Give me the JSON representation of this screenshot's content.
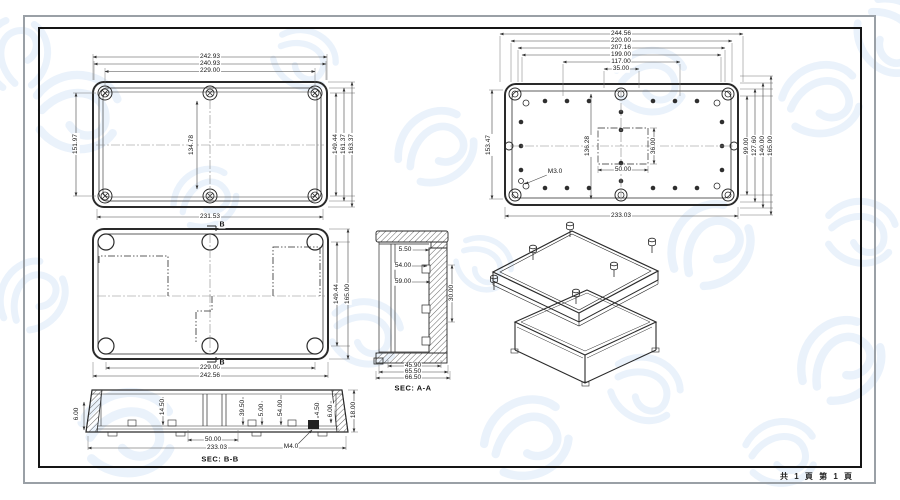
{
  "page": {
    "footer_pages": "共 1 頁  第 1 頁"
  },
  "views": {
    "lid_top_view": {
      "dims": {
        "width_outer": "242.93",
        "width_mid": "240.93",
        "width_screws": "229.00",
        "width_bottom": "231.53",
        "height_left": "151.97",
        "height_center": "134.78",
        "height_screws": "149.44",
        "height_mid": "161.37",
        "height_outer": "163.37"
      }
    },
    "base_top_view": {
      "dims": {
        "w1": "244.56",
        "w2": "220.00",
        "w3": "207.16",
        "w4": "199.00",
        "w5": "117.00",
        "w6": "35.00",
        "height_left": "153.47",
        "height_center": "136.28",
        "pocket_width": "50.00",
        "pocket_height": "36.00",
        "r1": "99.00",
        "r2": "127.60",
        "r3": "140.00",
        "r4": "165.00",
        "width_bottom": "233.03",
        "thread_note": "M3.0"
      }
    },
    "box_top_view": {
      "section_marker": "B",
      "dims": {
        "height_screws": "149.44",
        "height_outer": "165.00",
        "width_screws": "229.00",
        "width_outer": "242.56"
      }
    },
    "section_aa": {
      "title": "SEC: A-A",
      "dims": {
        "lip": "5.50",
        "inner_depth": "54.00",
        "depth": "59.00",
        "side": "30.00",
        "w1": "45.90",
        "w2": "65.50",
        "w3": "66.50"
      }
    },
    "section_bb": {
      "title": "SEC: B-B",
      "dims": {
        "left_height": "6.00",
        "d1": "14.50",
        "d2": "39.50",
        "d3": "5.00",
        "d4": "54.00",
        "d5": "4.50",
        "d6": "6.00",
        "right_height": "18.00",
        "w1": "50.00",
        "w2": "233.03",
        "thread_note": "M4.0"
      }
    }
  },
  "colors": {
    "line": "#2a2a2a",
    "dim_line": "#555555",
    "watermark": "#dce9f8",
    "frame_outer": "#9aa0a6",
    "frame_inner": "#151515"
  }
}
